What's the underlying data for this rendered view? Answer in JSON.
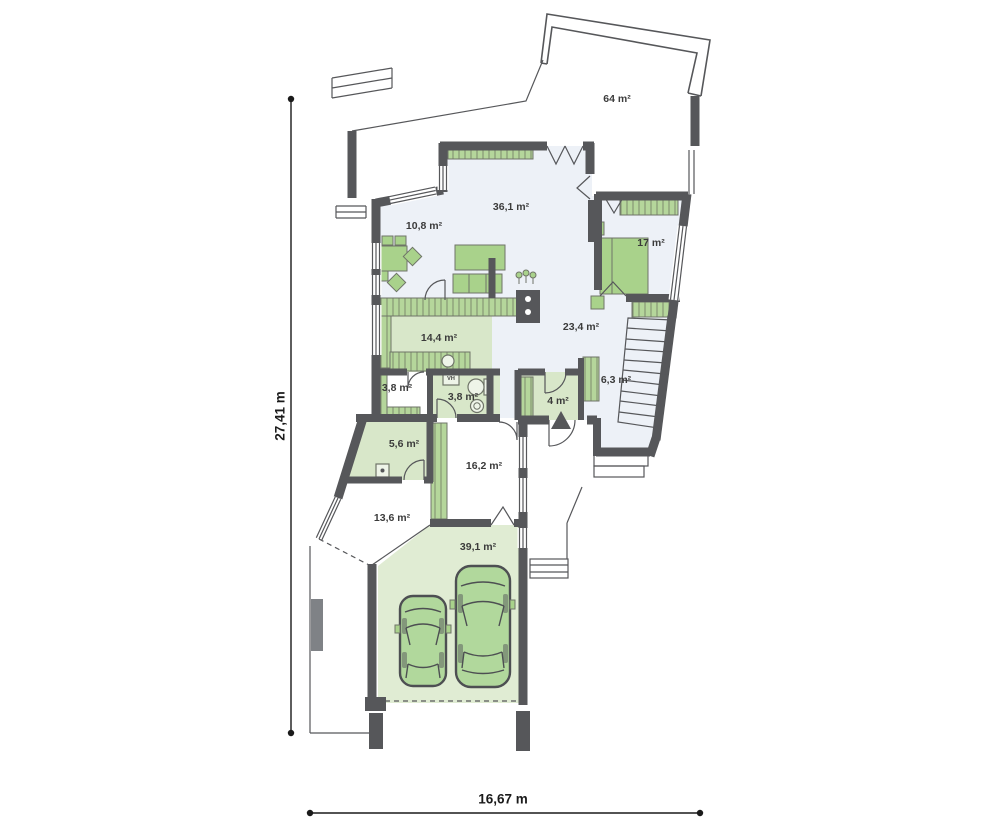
{
  "plan": {
    "rooms": [
      {
        "id": "terrace",
        "label": "64 m²",
        "x": 617,
        "y": 99
      },
      {
        "id": "living-room",
        "label": "36,1 m²",
        "x": 511,
        "y": 207
      },
      {
        "id": "dining-room",
        "label": "10,8 m²",
        "x": 424,
        "y": 226
      },
      {
        "id": "bedroom",
        "label": "17 m²",
        "x": 651,
        "y": 243
      },
      {
        "id": "kitchen",
        "label": "14,4 m²",
        "x": 439,
        "y": 338
      },
      {
        "id": "hall",
        "label": "23,4 m²",
        "x": 581,
        "y": 327
      },
      {
        "id": "pantry",
        "label": "3,8 m²",
        "x": 397,
        "y": 388
      },
      {
        "id": "bathroom",
        "label": "3,8 m²",
        "x": 463,
        "y": 397
      },
      {
        "id": "entry",
        "label": "4 m²",
        "x": 558,
        "y": 401
      },
      {
        "id": "vestibule",
        "label": "6,3 m²",
        "x": 616,
        "y": 380
      },
      {
        "id": "utility",
        "label": "5,6 m²",
        "x": 404,
        "y": 444
      },
      {
        "id": "mudroom",
        "label": "16,2 m²",
        "x": 484,
        "y": 466
      },
      {
        "id": "porch",
        "label": "13,6 m²",
        "x": 392,
        "y": 518
      },
      {
        "id": "garage",
        "label": "39,1 m²",
        "x": 478,
        "y": 547
      },
      {
        "id": "water-heater",
        "label": "VH",
        "x": 451,
        "y": 379,
        "size": "tiny"
      }
    ],
    "dimensions": {
      "vertical": {
        "label": "27,41 m"
      },
      "horizontal": {
        "label": "16,67 m"
      }
    },
    "colors": {
      "wall": "#56575a",
      "floor-blue": "#edf1f7",
      "floor-green": "#d8e7c9",
      "floor-garage": "#e0ecd3",
      "furniture": "#a9d28b",
      "furniture-stroke": "#6f7468",
      "car": "#b1d89c",
      "dim": "#1a1a1a",
      "label": "#3b3b3b"
    }
  }
}
